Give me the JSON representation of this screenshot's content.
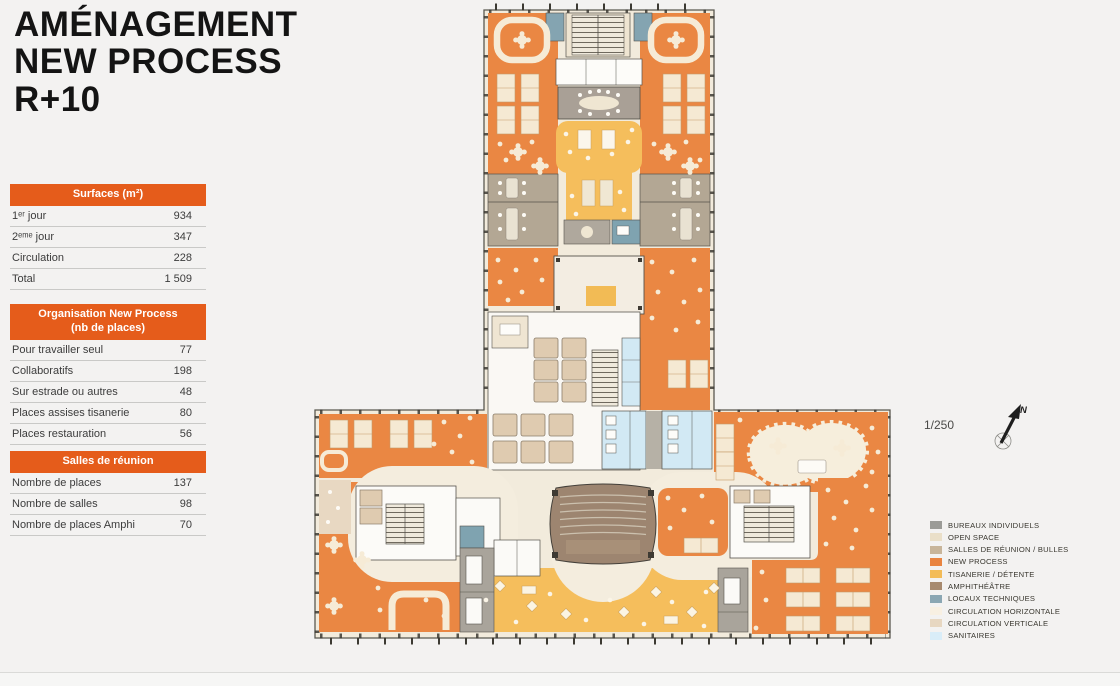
{
  "title": {
    "lines": [
      "AMÉNAGEMENT",
      "NEW PROCESS",
      "R+10"
    ]
  },
  "tables": {
    "surfaces": {
      "header": "Surfaces (m²)",
      "rows": [
        {
          "label": "1ᵉʳ jour",
          "value": "934"
        },
        {
          "label": "2ᵉᵐᵉ jour",
          "value": "347"
        },
        {
          "label": "Circulation",
          "value": "228"
        },
        {
          "label": "Total",
          "value": "1 509"
        }
      ]
    },
    "organisation": {
      "header_line1": "Organisation New Process",
      "header_line2": "(nb de places)",
      "rows": [
        {
          "label": "Pour travailler seul",
          "value": "77"
        },
        {
          "label": "Collaboratifs",
          "value": "198"
        },
        {
          "label": "Sur estrade ou autres",
          "value": "48"
        },
        {
          "label": "Places assises tisanerie",
          "value": "80"
        },
        {
          "label": "Places restauration",
          "value": "56"
        }
      ]
    },
    "salles": {
      "header": "Salles de réunion",
      "rows": [
        {
          "label": "Nombre de places",
          "value": "137"
        },
        {
          "label": "Nombre de salles",
          "value": "98"
        },
        {
          "label": "Nombre de places Amphi",
          "value": "70"
        }
      ]
    }
  },
  "plan": {
    "scale": "1/250",
    "north_label": "N"
  },
  "legend": {
    "items": [
      {
        "label": "BUREAUX INDIVIDUELS",
        "color": "#9b9b97"
      },
      {
        "label": "OPEN SPACE",
        "color": "#eadfc8"
      },
      {
        "label": "SALLES DE RÉUNION / BULLES",
        "color": "#c8b59a"
      },
      {
        "label": "NEW PROCESS",
        "color": "#e98440"
      },
      {
        "label": "TISANERIE / DÉTENTE",
        "color": "#f3bc58"
      },
      {
        "label": "AMPHITHÉÂTRE",
        "color": "#a78a6e"
      },
      {
        "label": "LOCAUX TECHNIQUES",
        "color": "#8ba7b3"
      },
      {
        "label": "CIRCULATION HORIZONTALE",
        "color": "#f8f0e2"
      },
      {
        "label": "CIRCULATION VERTICALE",
        "color": "#e7d7c1"
      },
      {
        "label": "SANITAIRES",
        "color": "#d9edf8"
      }
    ]
  },
  "colors": {
    "accent": "#e55c1b",
    "title_text": "#141414",
    "background": "#f3f2f1"
  }
}
